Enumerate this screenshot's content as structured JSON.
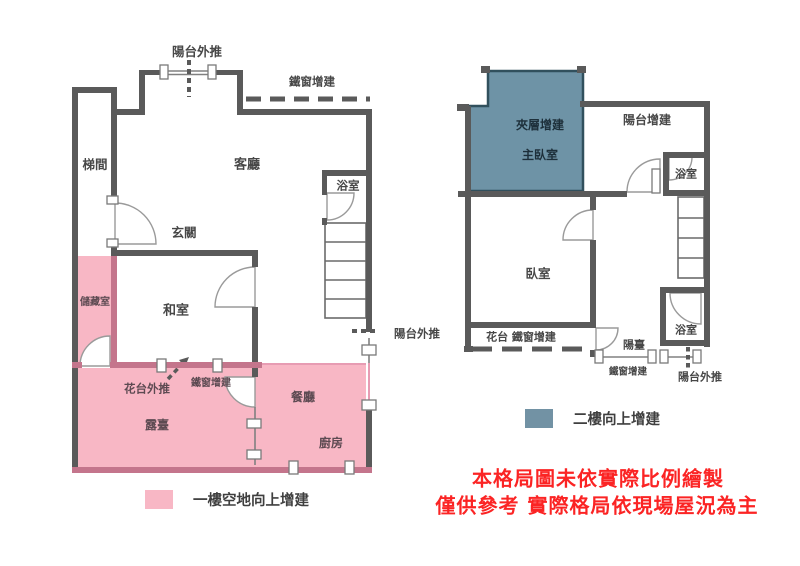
{
  "plans": {
    "first_floor": {
      "labels": {
        "balcony_pushout_top": "陽台外推",
        "iron_window_top": "鐵窗增建",
        "stairwell": "梯間",
        "living_room": "客廳",
        "entryway": "玄關",
        "bathroom": "浴室",
        "storage": "儲藏室",
        "tatami_room": "和室",
        "balcony_pushout_right": "陽台外推",
        "flower_stand_pushout": "花台外推",
        "iron_window_mid": "鐵窗增建",
        "dining_room": "餐廳",
        "terrace": "露臺",
        "kitchen": "廚房"
      }
    },
    "second_floor": {
      "labels": {
        "mezzanine_addition": "夾層增建",
        "master_bedroom": "主臥室",
        "balcony_addition": "陽台增建",
        "bathroom_upper": "浴室",
        "bedroom": "臥室",
        "flower_iron_window": "花台 鐵窗增建",
        "balcony": "陽臺",
        "iron_window_lower": "鐵窗增建",
        "bathroom_lower": "浴室",
        "balcony_pushout": "陽台外推"
      }
    }
  },
  "legend": [
    {
      "label": "一樓空地向上增建",
      "swatch_color": "#f8b7c5"
    },
    {
      "label": "二樓向上增建",
      "swatch_color": "#7292a4"
    }
  ],
  "disclaimer": {
    "line1": "本格局圖未依實際比例繪製",
    "line2": "僅供參考 實際格局依現場屋況為主",
    "color": "#fb2424"
  },
  "colors": {
    "wall": "#5a5a5a",
    "pink_fill": "#f8b7c5",
    "pink_wall": "#c4758c",
    "blue_fill": "#6e93a6",
    "blue_border": "#31505d",
    "label_text": "#474747"
  }
}
